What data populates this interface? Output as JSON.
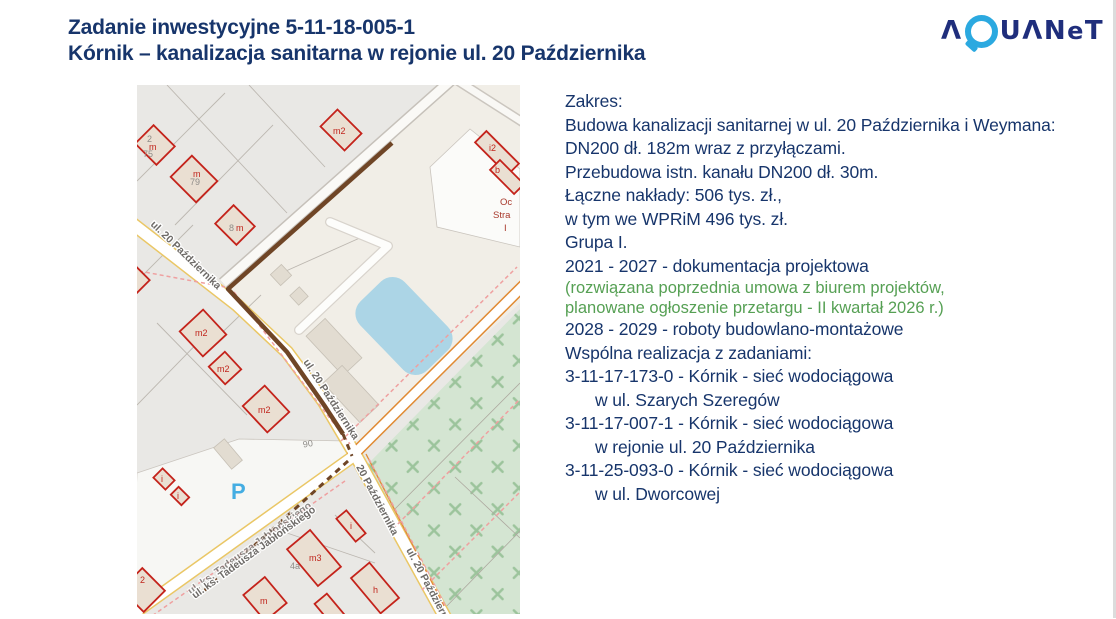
{
  "slide": {
    "title_line1": "Zadanie inwestycyjne 5-11-18-005-1",
    "title_line2": "Kórnik – kanalizacja sanitarna w rejonie ul. 20 Października"
  },
  "logo": {
    "part1": "Λ",
    "q": "Q",
    "part2": "UΛN",
    "e": "e",
    "t": "T",
    "name": "aquanet"
  },
  "colors": {
    "navy": "#17356B",
    "green": "#56A054",
    "logo_navy": "#1F2E7C",
    "logo_cyan": "#2BA9E0",
    "route_brown": "#6F4526",
    "building_red": "#C4231B",
    "pond_blue": "#ACD5E6",
    "green_area": "#D4E5D2",
    "road_yellow": "#EAC766",
    "road_orange": "#E08A33",
    "boundary_pink": "#EFA0A0",
    "parking_blue": "#44ADE2"
  },
  "content": {
    "scope": {
      "l1": "Zakres:",
      "l2": "Budowa kanalizacji sanitarnej w ul. 20 Października i Weymana:",
      "l3": "DN200 dł. 182m wraz z przyłączami.",
      "l4": "Przebudowa istn. kanału DN200 dł. 30m."
    },
    "costs": {
      "l1": "Łączne nakłady: 506 tys. zł.,",
      "l2": "w tym we WPRiM 496 tys. zł."
    },
    "group": "Grupa I.",
    "schedule": {
      "design": "2021 - 2027 - dokumentacja projektowa",
      "note1": "(rozwiązana poprzednia umowa z biurem projektów,",
      "note2": "planowane ogłoszenie przetargu - II kwartał 2026 r.)",
      "construction": "2028 - 2029 - roboty budowlano-montażowe"
    },
    "joint": {
      "header": "Wspólna realizacja z zadaniami:",
      "t1a": "3-11-17-173-0 - Kórnik - sieć wodociągowa",
      "t1b": "w ul. Szarych Szeregów",
      "t2a": "3-11-17-007-1 - Kórnik - sieć wodociągowa",
      "t2b": "w rejonie ul. 20 Października",
      "t3a": "3-11-25-093-0 - Kórnik - sieć wodociągowa",
      "t3b": "w ul. Dworcowej"
    }
  },
  "map": {
    "streets": {
      "s0": "ul. 20 Października",
      "s1": "ul. 20 Października",
      "s2": "20 Października",
      "s3": "ul. 20 Października",
      "s4": "ul. ks. Tadeusza Jabłońskiego"
    },
    "labels": {
      "p1": "2",
      "p2": "m",
      "p3": "75",
      "p4": "m",
      "p5": "79",
      "p6": "8",
      "p7": "m",
      "p8": "m2",
      "p9": "i2",
      "p10": "b",
      "p11": "m2",
      "p12": "m2",
      "p13": "m2",
      "p14": "90",
      "p15": "i",
      "p16": "i",
      "p17": "m3",
      "p18": "4a",
      "p19": "i",
      "p20": "h",
      "p21": "m",
      "p22": "2"
    },
    "parking": "P",
    "fire": {
      "l1": "Oc",
      "l2": "Stra",
      "l3": "I"
    }
  }
}
